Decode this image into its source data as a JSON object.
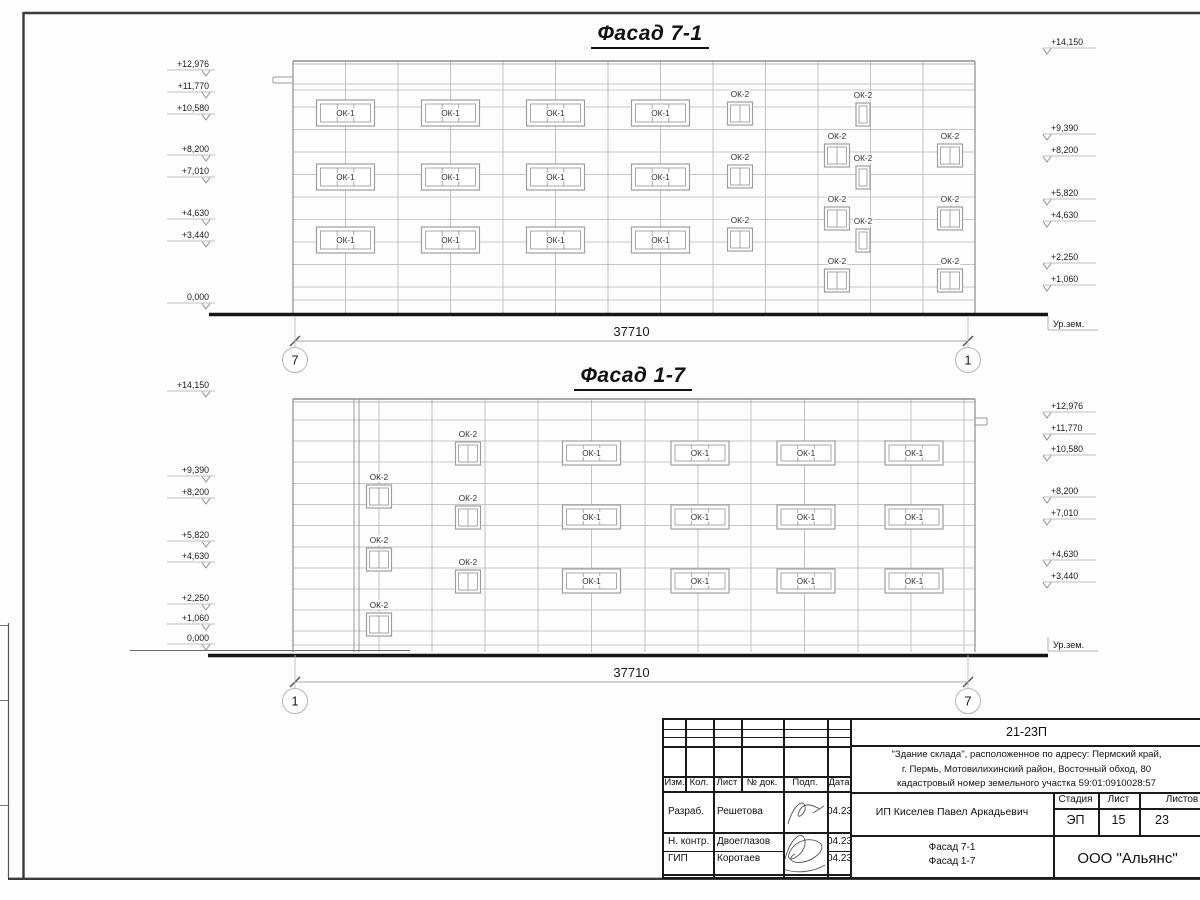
{
  "colors": {
    "ink": "#1a1a1a",
    "wall_line": "#8e8e8e",
    "panel_line": "#b3b3b3",
    "ground": "#161616"
  },
  "facades": [
    {
      "id": "facade-7-1",
      "title": "Фасад 7-1",
      "window_labels": {
        "ok1": "ОК-1",
        "ok2": "ОК-2"
      },
      "body": {
        "x1": 293,
        "x2": 975,
        "top": 61,
        "bottom": 313
      },
      "hlines": [
        84,
        90,
        107,
        129.5,
        152,
        174.5,
        197,
        219.5,
        242,
        264.5,
        287,
        300
      ],
      "vlines": [
        345.5,
        398,
        450.5,
        503,
        555.5,
        608,
        660.5,
        713,
        765.5,
        818,
        870.5,
        923
      ],
      "double_vlines": [],
      "notch": {
        "x1": 273,
        "x2": 293,
        "y1": 77,
        "y2": 83
      },
      "ok1": {
        "w": 58,
        "h": 26,
        "cols": [
          345.5,
          450.5,
          555.5,
          660.5
        ],
        "rows": [
          113,
          177,
          240
        ]
      },
      "ok2": [
        {
          "x": 740,
          "top": 102,
          "w": 25
        },
        {
          "x": 740,
          "top": 165,
          "w": 25
        },
        {
          "x": 740,
          "top": 228,
          "w": 25
        },
        {
          "x": 863,
          "top": 103,
          "w": 14
        },
        {
          "x": 863,
          "top": 166,
          "w": 14
        },
        {
          "x": 863,
          "top": 229,
          "w": 14
        },
        {
          "x": 837,
          "top": 144,
          "w": 25
        },
        {
          "x": 837,
          "top": 207,
          "w": 25
        },
        {
          "x": 837,
          "top": 269,
          "w": 25
        },
        {
          "x": 950,
          "top": 144,
          "w": 25
        },
        {
          "x": 950,
          "top": 207,
          "w": 25
        },
        {
          "x": 950,
          "top": 269,
          "w": 25
        }
      ],
      "ground": [
        {
          "x1": 209,
          "x2": 1048,
          "y": 314.5,
          "thick": true
        }
      ],
      "dimension": {
        "value": "37710",
        "x1": 295,
        "x2": 968,
        "y": 341
      },
      "bubbles": [
        {
          "label": "7",
          "x": 295,
          "cy": 360
        },
        {
          "label": "1",
          "x": 968,
          "cy": 360
        }
      ],
      "marks_left": [
        [
          "+12,976",
          67
        ],
        [
          "+11,770",
          89
        ],
        [
          "+10,580",
          111
        ],
        [
          "+8,200",
          152
        ],
        [
          "+7,010",
          174
        ],
        [
          "+4,630",
          216
        ],
        [
          "+3,440",
          238
        ],
        [
          "0,000",
          300
        ]
      ],
      "marks_right": [
        [
          "+14,150",
          45
        ],
        [
          "+9,390",
          131
        ],
        [
          "+8,200",
          153
        ],
        [
          "+5,820",
          196
        ],
        [
          "+4,630",
          218
        ],
        [
          "+2,250",
          260
        ],
        [
          "+1,060",
          282
        ]
      ],
      "ground_label": {
        "text": "Ур.зем.",
        "x": 1053,
        "y": 327
      }
    },
    {
      "id": "facade-1-7",
      "title": "Фасад 1-7",
      "window_labels": {
        "ok1": "ОК-1",
        "ok2": "ОК-2"
      },
      "body": {
        "x1": 293,
        "x2": 975,
        "top": 399,
        "bottom": 652
      },
      "hlines": [
        420,
        441,
        462,
        483.5,
        504.5,
        525.5,
        547,
        568,
        589,
        610,
        631,
        645
      ],
      "vlines": [
        379,
        432,
        485,
        538,
        591.5,
        645,
        698,
        751,
        804.5,
        858,
        911,
        964
      ],
      "double_vlines": [
        354,
        359
      ],
      "notch": {
        "x1": 975,
        "x2": 987,
        "y1": 418,
        "y2": 425
      },
      "ok1": {
        "w": 58,
        "h": 24,
        "cols": [
          591.5,
          700,
          806,
          914
        ],
        "rows": [
          453,
          517,
          581
        ]
      },
      "ok2": [
        {
          "x": 379,
          "top": 485,
          "w": 25
        },
        {
          "x": 379,
          "top": 548,
          "w": 25
        },
        {
          "x": 379,
          "top": 613,
          "w": 25
        },
        {
          "x": 468,
          "top": 442,
          "w": 25
        },
        {
          "x": 468,
          "top": 506,
          "w": 25
        },
        {
          "x": 468,
          "top": 570,
          "w": 25
        }
      ],
      "ground": [
        {
          "x1": 130,
          "x2": 410,
          "y": 650.5,
          "thick": false
        },
        {
          "x1": 208,
          "x2": 1048,
          "y": 655.5,
          "thick": true
        }
      ],
      "dimension": {
        "value": "37710",
        "x1": 295,
        "x2": 968,
        "y": 682
      },
      "bubbles": [
        {
          "label": "1",
          "x": 295,
          "cy": 701
        },
        {
          "label": "7",
          "x": 968,
          "cy": 701
        }
      ],
      "marks_left": [
        [
          "+14,150",
          388
        ],
        [
          "+9,390",
          473
        ],
        [
          "+8,200",
          495
        ],
        [
          "+5,820",
          538
        ],
        [
          "+4,630",
          559
        ],
        [
          "+2,250",
          601
        ],
        [
          "+1,060",
          621
        ],
        [
          "0,000",
          641
        ]
      ],
      "marks_right": [
        [
          "+12,976",
          409
        ],
        [
          "+11,770",
          431
        ],
        [
          "+10,580",
          452
        ],
        [
          "+8,200",
          494
        ],
        [
          "+7,010",
          516
        ],
        [
          "+4,630",
          557
        ],
        [
          "+3,440",
          579
        ]
      ],
      "ground_label": {
        "text": "Ур.зем.",
        "x": 1053,
        "y": 648
      }
    }
  ],
  "title_block": {
    "doc_number": "21-23П",
    "address": [
      "\"Здание склада\", расположенное по адресу: Пермский край,",
      "г. Пермь, Мотовилихинский район, Восточный обход, 80",
      "кадастровый номер земельного участка 59:01:0910028:57"
    ],
    "client": "ИП Киселев Павел Аркадьевич",
    "cols": [
      "Изм.",
      "Кол.",
      "Лист",
      "№ док.",
      "Подп.",
      "Дата"
    ],
    "rows": [
      {
        "role": "Разраб.",
        "name": "Решетова",
        "date": "04.23"
      },
      {
        "role": "Н. контр.",
        "name": "Двоеглазов",
        "date": "04.23"
      },
      {
        "role": "ГИП",
        "name": "Коротаев",
        "date": "04.23"
      }
    ],
    "stage_label": "Стадия",
    "sheet_label": "Лист",
    "sheets_label": "Листов",
    "stage": "ЭП",
    "sheet": "15",
    "sheets": "23",
    "subject": [
      "Фасад 7-1",
      "Фасад 1-7"
    ],
    "company": "ООО \"Альянс\""
  }
}
